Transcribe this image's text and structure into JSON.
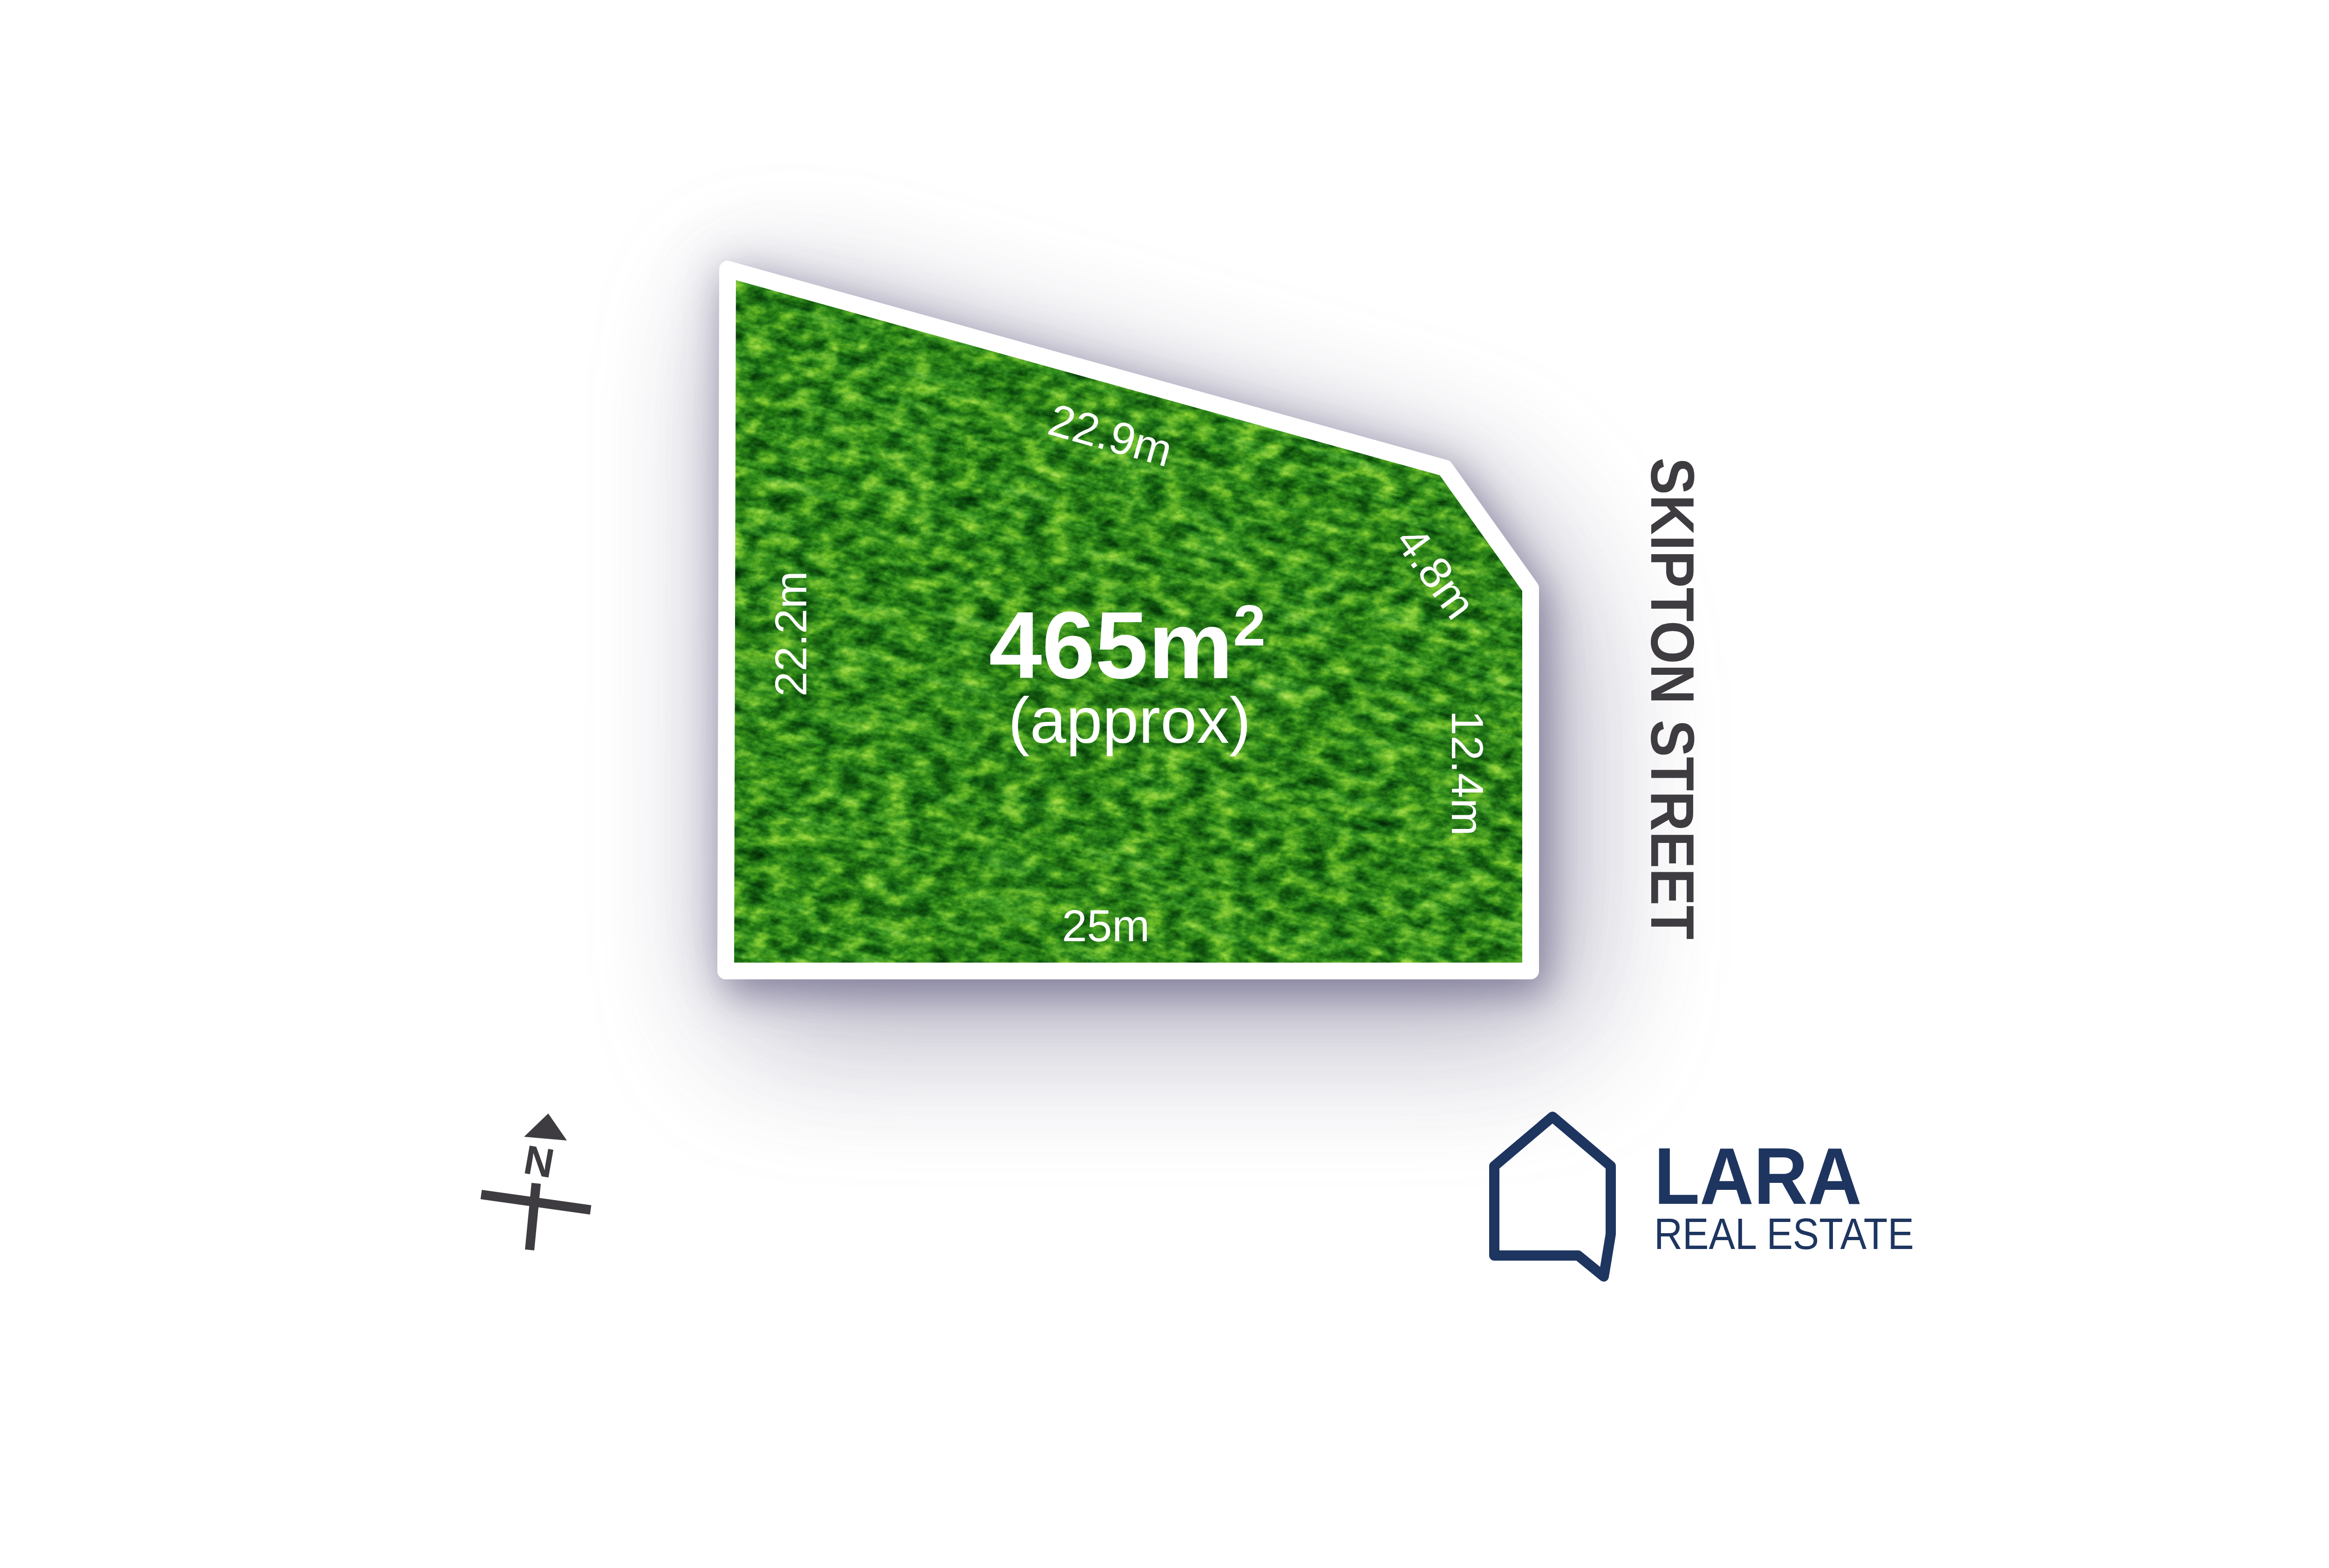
{
  "parcel": {
    "area": "465m",
    "area_superscript": "2",
    "area_note": "(approx)",
    "dimensions": {
      "top": "22.9m",
      "cut_corner": "4.8m",
      "right": "12.4m",
      "bottom": "25m",
      "left": "22.2m"
    },
    "border_color": "#ffffff",
    "grass_base_color": "#46a83b",
    "label_color": "#ffffff",
    "shadow_color": "#686386"
  },
  "street": {
    "name": "SKIPTON STREET",
    "color": "#3e3c40"
  },
  "compass": {
    "label": "N",
    "color": "#3e3c40"
  },
  "logo": {
    "brand": "LARA",
    "tagline": "REAL ESTATE",
    "color": "#1e3560"
  }
}
